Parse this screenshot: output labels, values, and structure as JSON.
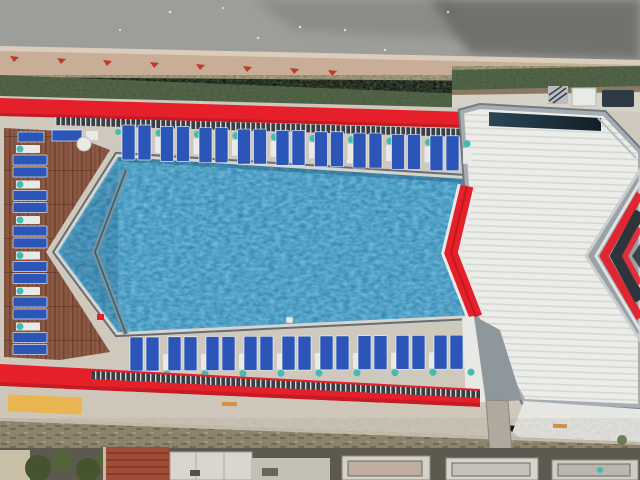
{
  "scene": {
    "type": "aerial-photograph",
    "subject": "Top-down drone view of a rooftop swimming pool with rows of blue sun loungers, red trim bands, a wooden deck, and a white corrugated roof wing",
    "time_of_day": "daylight"
  },
  "palette": {
    "asphalt": "#9d9d9a",
    "asphaltDark": "#68696512",
    "asphaltDarkSolid": "#666762",
    "sidewalk": "#c9ae97",
    "sidewalkLight": "#e0d4c4",
    "redMark": "#c0392b",
    "hedge": "#46543c",
    "planterSoil": "#8a7a62",
    "pathLight": "#d6d2c8",
    "deck": "#cfc8bc",
    "wood": "#8b5943",
    "woodDark": "#70432f",
    "red": "#e5202a",
    "redDark": "#a8161d",
    "water": "#1b77a8",
    "waterLight": "#3f9fd0",
    "coping": "#d7d3cd",
    "rim": "#5a646c",
    "innerBench": "#7a95a0",
    "lounger": "#2c55b8",
    "chairWhite": "#e9eae8",
    "teal": "#3fbdb2",
    "roof": "#ecede9",
    "roofLine": "#d6d8d3",
    "frame": "#a6aeb4",
    "frameDark": "#707a82",
    "glass": "#22333f",
    "wingGray": "#9aa2a6",
    "wingDark": "#2c353c",
    "road": "#cdc6b9",
    "yellow": "#e9b44c",
    "orange": "#d68f45",
    "wall": "#8c8069",
    "wallDark": "#6e6350",
    "groundDark": "#5d594f",
    "terracotta": "#9e4c36",
    "terracottaDark": "#7c3826",
    "buildingWhite": "#d8d6cf",
    "tree": "#46532f",
    "treeLight": "#55653a"
  },
  "loungers": {
    "top_row": {
      "groups": 9,
      "per_group": 2,
      "startX": 122,
      "pitch": 38.5,
      "y": 125,
      "slope": 0.035,
      "w": 13,
      "h": 35,
      "gap": 3
    },
    "bottom_row": {
      "groups": 9,
      "per_group": 2,
      "startX": 130,
      "pitch": 38.0,
      "y": 337,
      "slope": -0.006,
      "w": 13,
      "h": 34,
      "gap": 3
    },
    "left_column": {
      "groups": 6,
      "per_group": 2,
      "x": 13,
      "startY": 145,
      "pitch": 35.5,
      "w": 34,
      "h": 10,
      "gap": 2
    }
  },
  "features": {
    "pool_shape": "elongated chevron pointing left",
    "roof": "white corrugated metal with red chevron trim",
    "deck_left": "red-brown wooden planks",
    "markings": [
      "yellow painted rectangle on lower road",
      "red tick marks on upper sidewalk"
    ]
  }
}
